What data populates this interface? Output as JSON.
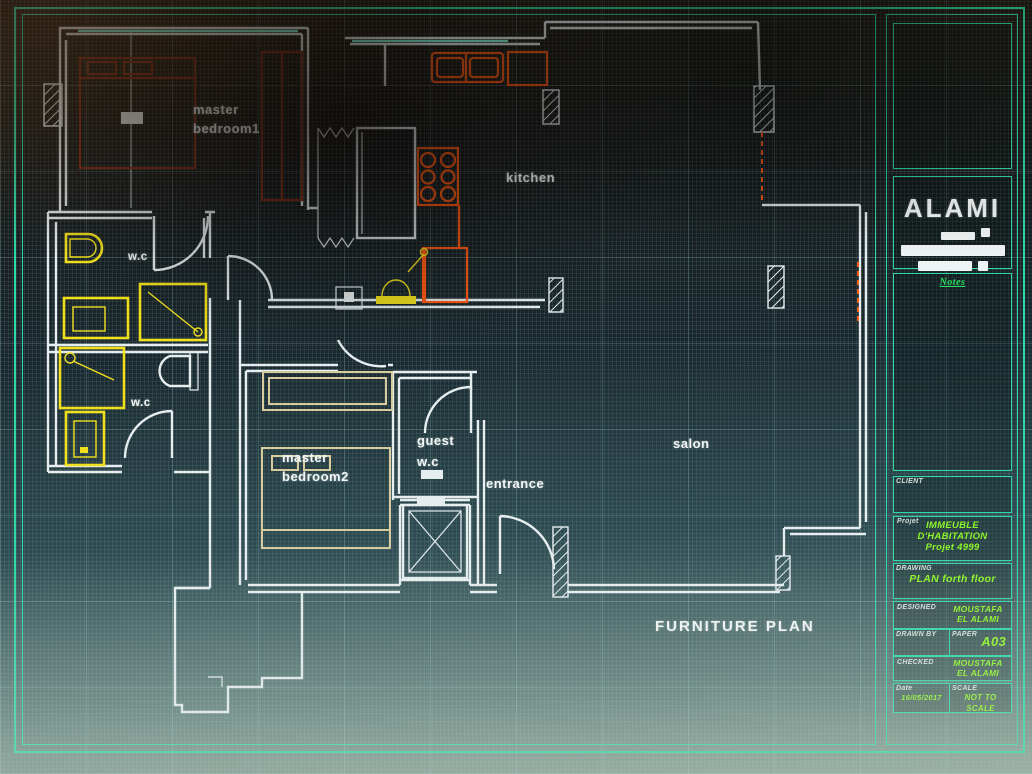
{
  "drawing": {
    "plan_title": "FURNITURE PLAN",
    "rooms": {
      "master_bedroom1": {
        "line1": "master",
        "line2": "bedroom1"
      },
      "wc_upper": {
        "label": "w.c"
      },
      "wc_lower": {
        "label": "w.c"
      },
      "kitchen": {
        "label": "kitchen"
      },
      "guest_wc": {
        "line1": "guest",
        "line2": "w.c"
      },
      "entrance": {
        "label": "entrance"
      },
      "salon": {
        "label": "salon"
      },
      "master_bedroom2": {
        "line1": "master",
        "line2": "bedroom2"
      }
    },
    "colors": {
      "walls": "#e6edef",
      "windows": "#86ffdf",
      "bathroom_fixtures": "#f0df1e",
      "kitchen_fixtures": "#ff5a14",
      "bedroom1_furniture": "#82301a",
      "bedroom2_furniture": "#d8cc9e",
      "grid": "#9adada",
      "frame": "#2fd9a6",
      "green_text": "#8ef52a"
    }
  },
  "title_block": {
    "company": "ALAMI",
    "notes_heading": "Notes",
    "client_label": "CLIENT",
    "project": {
      "label": "Projet",
      "line1": "IMMEUBLE",
      "line2": "D'HABITATION",
      "line3": "Projet 4999"
    },
    "drawing_field": {
      "label": "DRAWING",
      "value": "PLAN forth floor"
    },
    "designed": {
      "label": "DESIGNED",
      "value": "MOUSTAFA EL ALAMI"
    },
    "drawn": {
      "label": "DRAWN BY"
    },
    "paper": {
      "label": "PAPER",
      "value": "A03"
    },
    "checked": {
      "label": "CHECKED",
      "value": "MOUSTAFA EL ALAMI"
    },
    "date": {
      "label": "Date",
      "value": "16/05/2017"
    },
    "scale": {
      "label": "SCALE",
      "value": "NOT TO SCALE"
    }
  }
}
